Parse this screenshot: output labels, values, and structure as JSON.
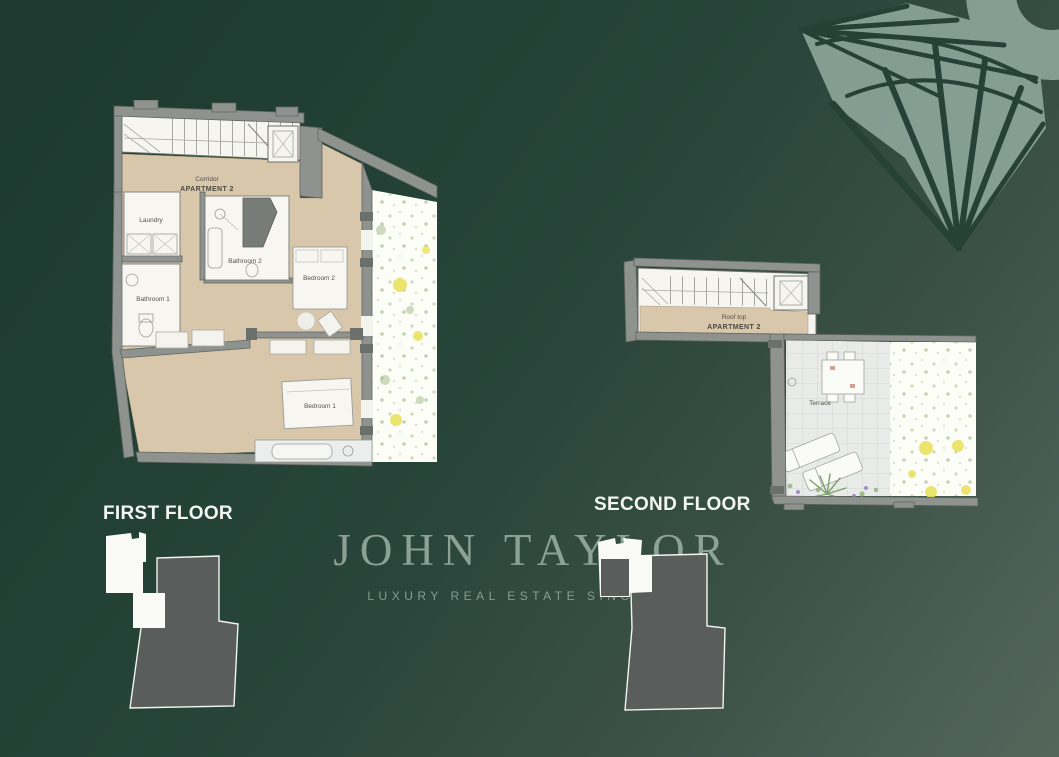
{
  "page": {
    "background": {
      "top_left": "#1e3a30",
      "bottom_right": "#53655b"
    }
  },
  "brand": {
    "logo": "JOHN TAYLOR",
    "tagline": "LUXURY REAL ESTATE SINCE 1864",
    "logo_color": "#a4b8ac",
    "emblem_icon": "fan-ornament-icon"
  },
  "floor_plans": {
    "first": {
      "title": "FIRST FLOOR",
      "labels": {
        "corridor": "Corridor",
        "apartment": "APARTMENT 2",
        "laundry": "Laundry",
        "bathroom_2": "Bathroom 2",
        "bathroom_1": "Bathroom 1",
        "bedroom_2": "Bedroom 2",
        "bedroom_1": "Bedroom 1"
      }
    },
    "second": {
      "title": "SECOND FLOOR",
      "labels": {
        "roof_top": "Roof top",
        "apartment": "APARTMENT 2",
        "terrace": "Terrace"
      }
    }
  },
  "colors": {
    "wall_gray": "#8f938f",
    "floor_beige": "#d8c7ab",
    "room_white": "#f7f6f1",
    "paving_gray": "#e9ebe8",
    "garden_white": "#fdfdf8",
    "garden_accent_yellow": "#e9e15e",
    "keyplan_dark": "#595d5b",
    "keyplan_highlight": "#fafbf8"
  }
}
